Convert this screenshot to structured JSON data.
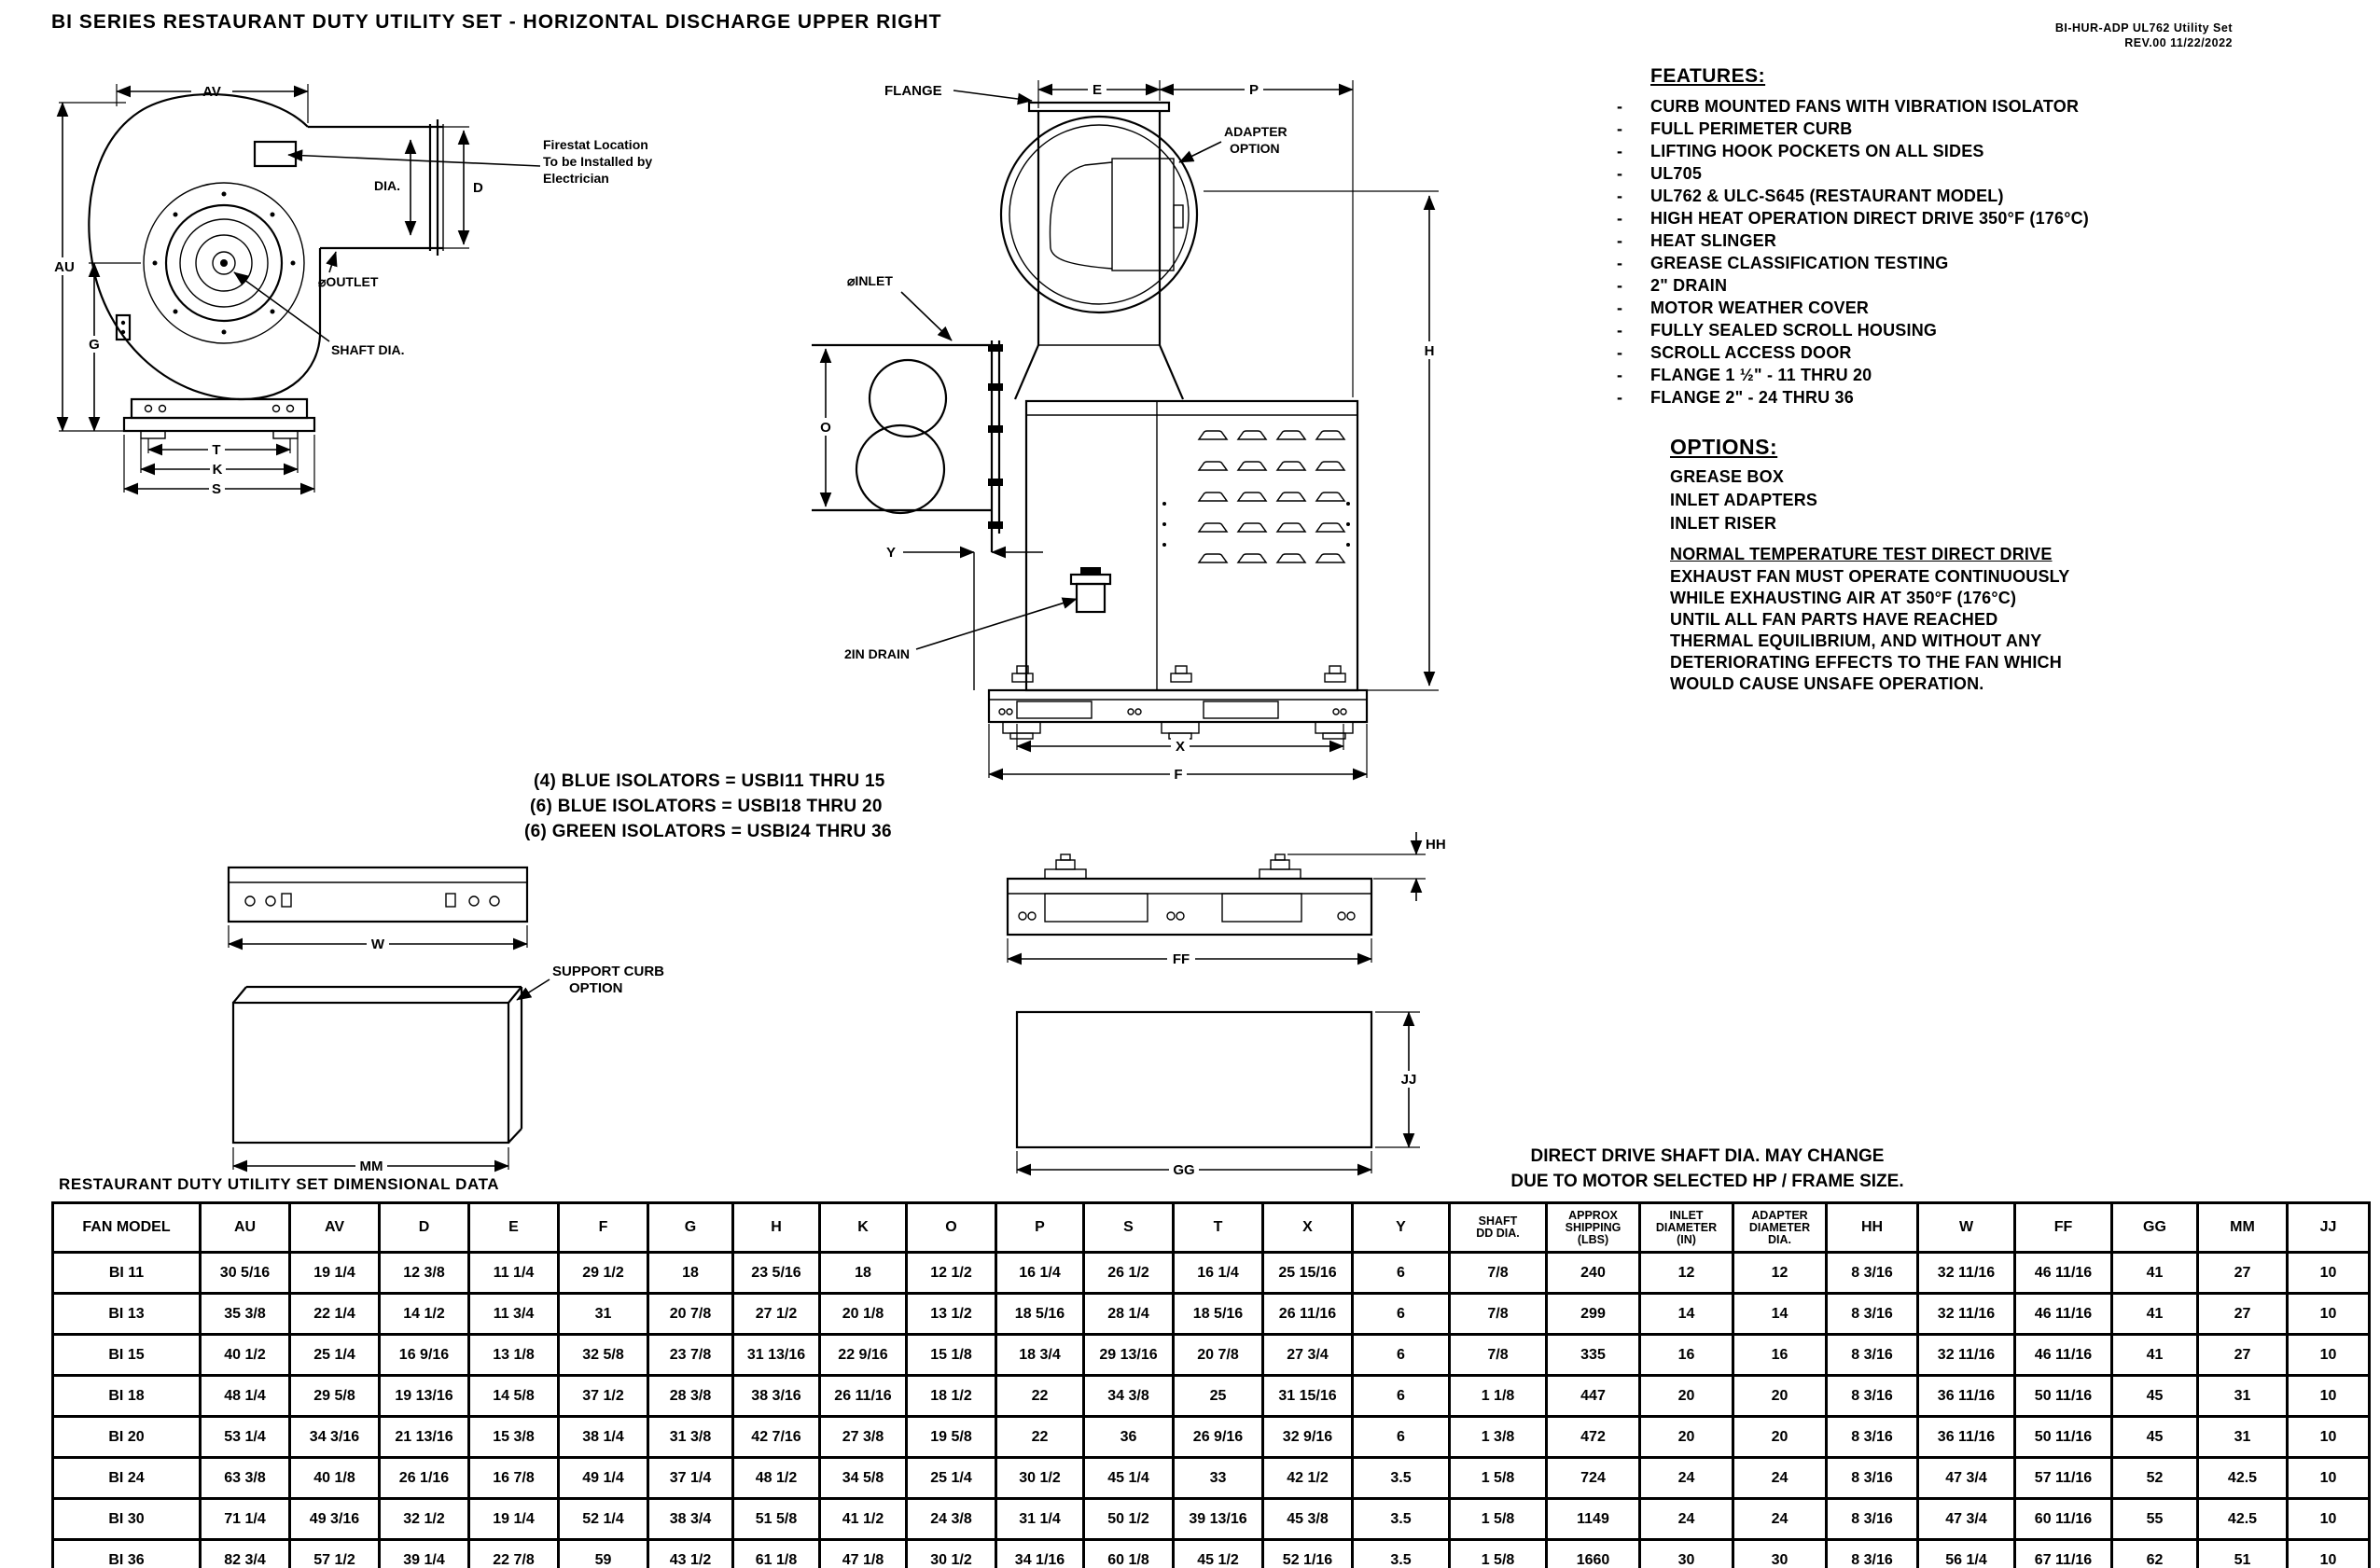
{
  "header": {
    "title": "BI SERIES RESTAURANT DUTY UTILITY SET - HORIZONTAL DISCHARGE UPPER RIGHT",
    "doc_line1": "BI-HUR-ADP UL762 Utility Set",
    "doc_line2": "REV.00    11/22/2022"
  },
  "features": {
    "heading": "FEATURES:",
    "items": [
      "CURB MOUNTED FANS WITH VIBRATION ISOLATOR",
      "FULL PERIMETER CURB",
      "LIFTING HOOK POCKETS ON ALL SIDES",
      "UL705",
      "UL762 & ULC-S645 (RESTAURANT MODEL)",
      "HIGH HEAT OPERATION DIRECT DRIVE 350°F (176°C)",
      "HEAT SLINGER",
      "GREASE CLASSIFICATION TESTING",
      "2\" DRAIN",
      "MOTOR WEATHER COVER",
      "FULLY SEALED SCROLL HOUSING",
      "SCROLL ACCESS DOOR",
      "FLANGE 1 ½\" - 11 THRU 20",
      "FLANGE 2\" - 24 THRU 36"
    ]
  },
  "options": {
    "heading": "OPTIONS:",
    "items": [
      "GREASE BOX",
      "INLET ADAPTERS",
      "INLET RISER"
    ]
  },
  "note": {
    "heading": "NORMAL TEMPERATURE TEST DIRECT DRIVE",
    "lines": [
      "EXHAUST FAN MUST OPERATE CONTINUOUSLY",
      "WHILE EXHAUSTING AIR AT 350°F (176°C)",
      "UNTIL ALL FAN PARTS HAVE REACHED",
      "THERMAL EQUILIBRIUM, AND WITHOUT ANY",
      "DETERIORATING EFFECTS TO THE FAN WHICH",
      "WOULD CAUSE UNSAFE OPERATION."
    ]
  },
  "isolators": {
    "lines": [
      "(4) BLUE ISOLATORS = USBI11 THRU 15",
      "(6) BLUE ISOLATORS = USBI18 THRU 20",
      "(6) GREEN ISOLATORS = USBI24 THRU 36"
    ]
  },
  "drawings": {
    "left": {
      "av": "AV",
      "au": "AU",
      "g": "G",
      "t": "T",
      "k": "K",
      "s": "S",
      "dia": "DIA.",
      "d": "D",
      "outlet": "⌀OUTLET",
      "shaft": "SHAFT DIA.",
      "firestat": [
        "Firestat Location",
        "To be Installed by",
        "Electrician"
      ]
    },
    "middle": {
      "flange": "FLANGE",
      "e": "E",
      "p": "P",
      "adapter": [
        "ADAPTER",
        "OPTION"
      ],
      "inlet": "⌀INLET",
      "o": "O",
      "y": "Y",
      "drain": "2IN DRAIN",
      "h": "H",
      "x": "X",
      "f": "F"
    },
    "bottom_left": {
      "w": "W",
      "mm": "MM",
      "support": [
        "SUPPORT CURB",
        "OPTION"
      ]
    },
    "bottom_mid": {
      "hh": "HH",
      "ff": "FF",
      "gg": "GG",
      "jj": "JJ"
    }
  },
  "table_caption": "RESTAURANT DUTY UTILITY SET DIMENSIONAL DATA",
  "table_note": {
    "line1": "DIRECT DRIVE SHAFT DIA. MAY CHANGE",
    "line2": "DUE TO MOTOR SELECTED HP / FRAME SIZE."
  },
  "table": {
    "headers": [
      "FAN MODEL",
      "AU",
      "AV",
      "D",
      "E",
      "F",
      "G",
      "H",
      "K",
      "O",
      "P",
      "S",
      "T",
      "X",
      "Y",
      "SHAFT\nDD DIA.",
      "APPROX\nSHIPPING\n(LBS)",
      "INLET\nDIAMETER\n(IN)",
      "ADAPTER\nDIAMETER\nDIA.",
      "HH",
      "W",
      "FF",
      "GG",
      "MM",
      "JJ"
    ],
    "rows": [
      [
        "BI 11",
        "30 5/16",
        "19 1/4",
        "12 3/8",
        "11 1/4",
        "29 1/2",
        "18",
        "23 5/16",
        "18",
        "12 1/2",
        "16 1/4",
        "26 1/2",
        "16 1/4",
        "25 15/16",
        "6",
        "7/8",
        "240",
        "12",
        "12",
        "8 3/16",
        "32 11/16",
        "46 11/16",
        "41",
        "27",
        "10"
      ],
      [
        "BI 13",
        "35 3/8",
        "22 1/4",
        "14 1/2",
        "11 3/4",
        "31",
        "20 7/8",
        "27 1/2",
        "20 1/8",
        "13 1/2",
        "18 5/16",
        "28 1/4",
        "18 5/16",
        "26 11/16",
        "6",
        "7/8",
        "299",
        "14",
        "14",
        "8 3/16",
        "32 11/16",
        "46 11/16",
        "41",
        "27",
        "10"
      ],
      [
        "BI 15",
        "40 1/2",
        "25 1/4",
        "16 9/16",
        "13 1/8",
        "32 5/8",
        "23 7/8",
        "31 13/16",
        "22 9/16",
        "15 1/8",
        "18 3/4",
        "29 13/16",
        "20 7/8",
        "27 3/4",
        "6",
        "7/8",
        "335",
        "16",
        "16",
        "8 3/16",
        "32 11/16",
        "46 11/16",
        "41",
        "27",
        "10"
      ],
      [
        "BI 18",
        "48 1/4",
        "29 5/8",
        "19 13/16",
        "14 5/8",
        "37 1/2",
        "28 3/8",
        "38 3/16",
        "26 11/16",
        "18 1/2",
        "22",
        "34 3/8",
        "25",
        "31 15/16",
        "6",
        "1 1/8",
        "447",
        "20",
        "20",
        "8 3/16",
        "36 11/16",
        "50 11/16",
        "45",
        "31",
        "10"
      ],
      [
        "BI 20",
        "53 1/4",
        "34 3/16",
        "21 13/16",
        "15 3/8",
        "38 1/4",
        "31 3/8",
        "42 7/16",
        "27 3/8",
        "19 5/8",
        "22",
        "36",
        "26 9/16",
        "32 9/16",
        "6",
        "1 3/8",
        "472",
        "20",
        "20",
        "8 3/16",
        "36 11/16",
        "50 11/16",
        "45",
        "31",
        "10"
      ],
      [
        "BI 24",
        "63 3/8",
        "40 1/8",
        "26 1/16",
        "16 7/8",
        "49 1/4",
        "37 1/4",
        "48 1/2",
        "34 5/8",
        "25 1/4",
        "30 1/2",
        "45 1/4",
        "33",
        "42 1/2",
        "3.5",
        "1 5/8",
        "724",
        "24",
        "24",
        "8 3/16",
        "47 3/4",
        "57 11/16",
        "52",
        "42.5",
        "10"
      ],
      [
        "BI 30",
        "71 1/4",
        "49 3/16",
        "32 1/2",
        "19 1/4",
        "52 1/4",
        "38 3/4",
        "51 5/8",
        "41 1/2",
        "24 3/8",
        "31 1/4",
        "50 1/2",
        "39 13/16",
        "45 3/8",
        "3.5",
        "1 5/8",
        "1149",
        "24",
        "24",
        "8 3/16",
        "47 3/4",
        "60 11/16",
        "55",
        "42.5",
        "10"
      ],
      [
        "BI 36",
        "82 3/4",
        "57 1/2",
        "39 1/4",
        "22 7/8",
        "59",
        "43 1/2",
        "61 1/8",
        "47 1/8",
        "30 1/2",
        "34 1/16",
        "60 1/8",
        "45 1/2",
        "52 1/16",
        "3.5",
        "1 5/8",
        "1660",
        "30",
        "30",
        "8 3/16",
        "56 1/4",
        "67 11/16",
        "62",
        "51",
        "10"
      ]
    ]
  }
}
